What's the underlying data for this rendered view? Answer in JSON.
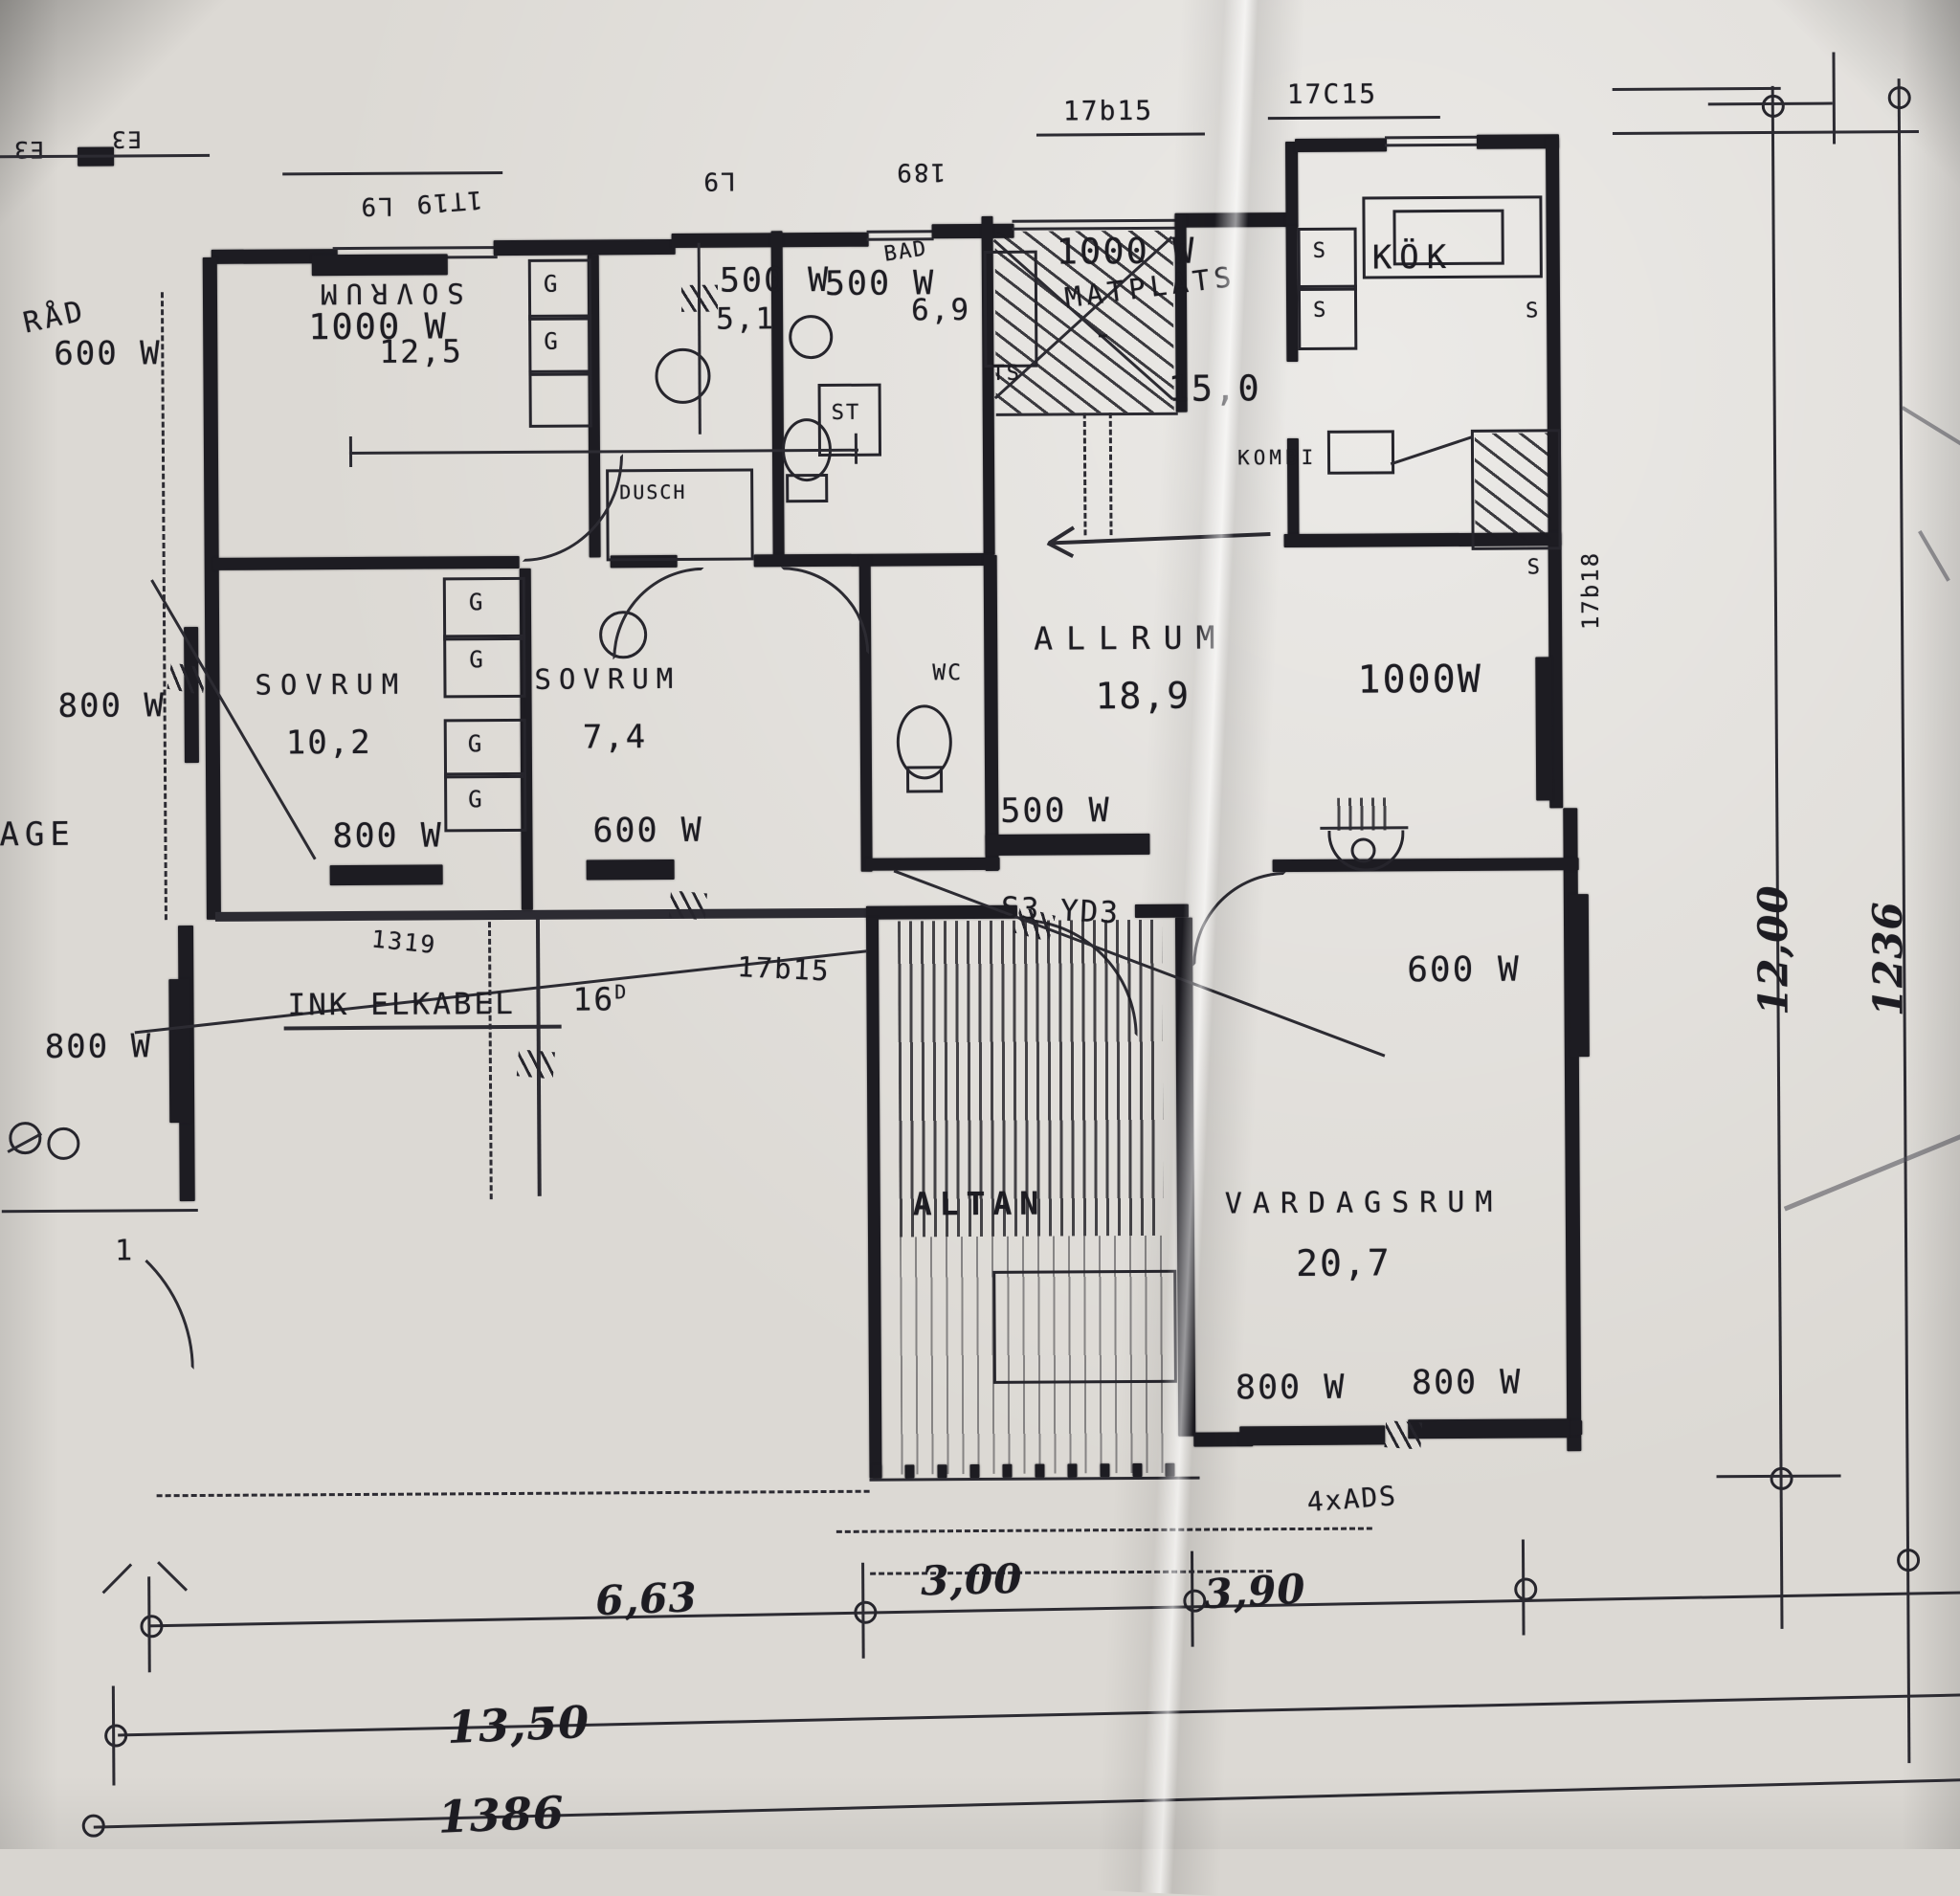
{
  "rooms": {
    "sovrum1": {
      "name": "SOVRUM",
      "watt": "1000 W",
      "area": "12,5"
    },
    "sovrum2": {
      "name": "SOVRUM",
      "area": "10,2",
      "watt": "800 W"
    },
    "sovrum3": {
      "name": "SOVRUM",
      "area": "7,4",
      "watt": "600 W"
    },
    "bad1": {
      "watt": "500 W",
      "area": "5,1"
    },
    "bad2": {
      "name": "BAD",
      "watt": "500 W",
      "area": "6,9"
    },
    "matplats": {
      "name": "MATPLATS",
      "watt": "1000 W",
      "area": "15,0",
      "dash": "-"
    },
    "kok": {
      "name": "KÖK"
    },
    "allrum": {
      "name": "ALLRUM",
      "area": "18,9"
    },
    "east": {
      "watt": "1000W"
    },
    "hall": {
      "watt": "500 W"
    },
    "east2": {
      "watt": "600 W"
    },
    "vardagsrum": {
      "name": "VARDAGSRUM",
      "area": "20,7",
      "watt_left": "800 W",
      "watt_right": "800 W"
    },
    "altan": {
      "name": "ALTAN"
    },
    "garage": {
      "label": "AGE",
      "watt": "800 W",
      "door": "1"
    },
    "forrad": {
      "label": "RÅD",
      "watt": "600 W"
    },
    "west": {
      "watt": "800 W"
    }
  },
  "fixtures": {
    "wc": "WC",
    "st": "ST",
    "ts": "TS",
    "dusch": "DUSCH",
    "kombi": "KOMBI",
    "g": "G",
    "s": "S"
  },
  "codes": {
    "tl1": "L9",
    "tl2": "1T19",
    "tm1": "L9",
    "tm2": "189",
    "tc": "17b15",
    "tr": "17C15",
    "h1": "1319",
    "h2": "16",
    "h2s": "D",
    "h3": "17b15",
    "door": "S3 YD3",
    "ads": "4xADS",
    "rv": "17b18",
    "e1": "E3",
    "e2": "E3"
  },
  "notes": {
    "cable": "INK ELKABEL"
  },
  "dims": {
    "b1": "6,63",
    "b2": "3,00",
    "b3": "3,90",
    "b4": "13,50",
    "b5": "1386",
    "r1": "12,00",
    "r2": "1236"
  }
}
